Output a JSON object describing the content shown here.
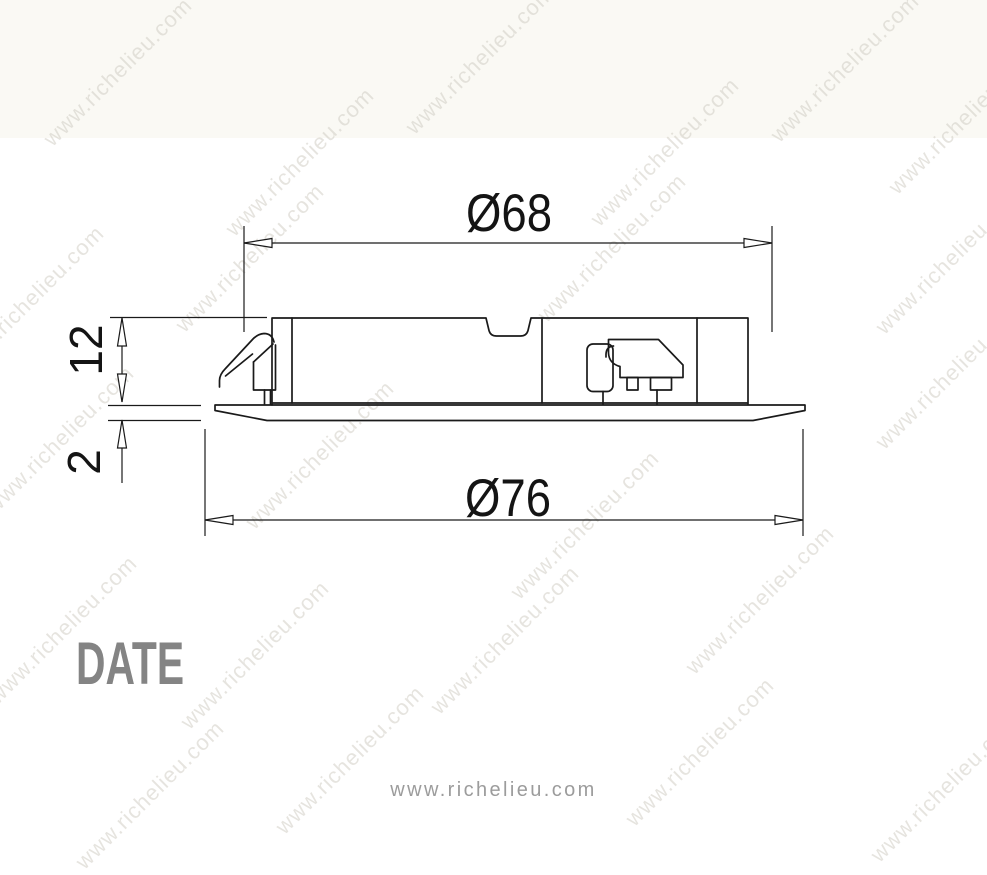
{
  "page": {
    "background_watermark_text": "www.richelieu.com",
    "footer_url": "www.richelieu.com",
    "date_label": "DATE"
  },
  "diagram": {
    "type": "technical-drawing",
    "dimensions": {
      "top_diameter_label": "Ø68",
      "bottom_diameter_label": "Ø76",
      "body_height_label": "12",
      "flange_thickness_label": "2"
    }
  },
  "colors": {
    "line": "#1a1a1a",
    "date_text": "#848484",
    "footer_text": "#9c9c9c",
    "watermark": "#d2cfc6",
    "top_band_bg": "#faf9f4"
  }
}
